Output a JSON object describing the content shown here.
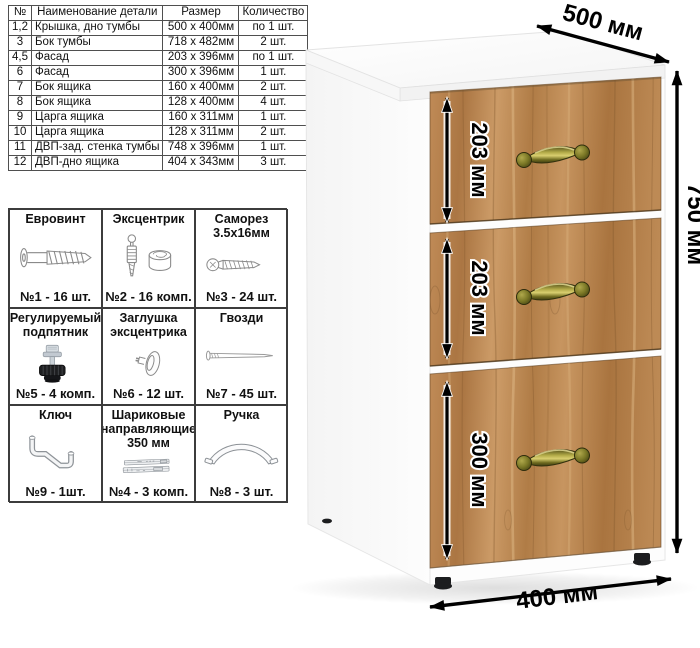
{
  "parts_table": {
    "headers": [
      "№",
      "Наименование детали",
      "Размер",
      "Количество"
    ],
    "rows": [
      [
        "1,2",
        "Крышка, дно тумбы",
        "500 х 400мм",
        "по 1 шт."
      ],
      [
        "3",
        "Бок тумбы",
        "718 х 482мм",
        "2 шт."
      ],
      [
        "4,5",
        "Фасад",
        "203 х 396мм",
        "по 1 шт."
      ],
      [
        "6",
        "Фасад",
        "300 х 396мм",
        "1 шт."
      ],
      [
        "7",
        "Бок ящика",
        "160 х 400мм",
        "2 шт."
      ],
      [
        "8",
        "Бок ящика",
        "128 х 400мм",
        "4 шт."
      ],
      [
        "9",
        "Царга ящика",
        "160 х 311мм",
        "1 шт."
      ],
      [
        "10",
        "Царга ящика",
        "128 х 311мм",
        "2 шт."
      ],
      [
        "11",
        "ДВП-зад. стенка тумбы",
        "748 х 396мм",
        "1 шт."
      ],
      [
        "12",
        "ДВП-дно ящика",
        "404 х 343мм",
        "3 шт."
      ]
    ]
  },
  "hardware": {
    "items": [
      {
        "name": "Евровинт",
        "count": "№1 - 16 шт.",
        "icon": "euroscrew-icon"
      },
      {
        "name": "Эксцентрик",
        "count": "№2 - 16 комп.",
        "icon": "cam-icon"
      },
      {
        "name": "Саморез 3.5х16мм",
        "count": "№3 - 24 шт.",
        "icon": "screw-icon"
      },
      {
        "name": "Регулируемый подпятник",
        "count": "№5 - 4 комп.",
        "icon": "foot-icon"
      },
      {
        "name": "Заглушка эксцентрика",
        "count": "№6 - 12 шт.",
        "icon": "cap-icon"
      },
      {
        "name": "Гвозди",
        "count": "№7 - 45 шт.",
        "icon": "nail-icon"
      },
      {
        "name": "Ключ",
        "count": "№9 - 1шт.",
        "icon": "key-icon"
      },
      {
        "name": "Шариковые направляющие 350 мм",
        "count": "№4 - 3 комп.",
        "icon": "slides-icon"
      },
      {
        "name": "Ручка",
        "count": "№8 - 3 шт.",
        "icon": "bowhandle-icon"
      }
    ]
  },
  "cabinet": {
    "dim_depth": "500 мм",
    "dim_height": "750 мм",
    "dim_width": "400 мм",
    "dim_drawer_top": "203 мм",
    "dim_drawer_middle": "203 мм",
    "dim_drawer_bottom": "300 мм",
    "colors": {
      "wood": "#b9834e",
      "handle_bronze": "#7c7a22",
      "dimension_lines": "#000000",
      "carcass_white": "#ffffff"
    }
  }
}
